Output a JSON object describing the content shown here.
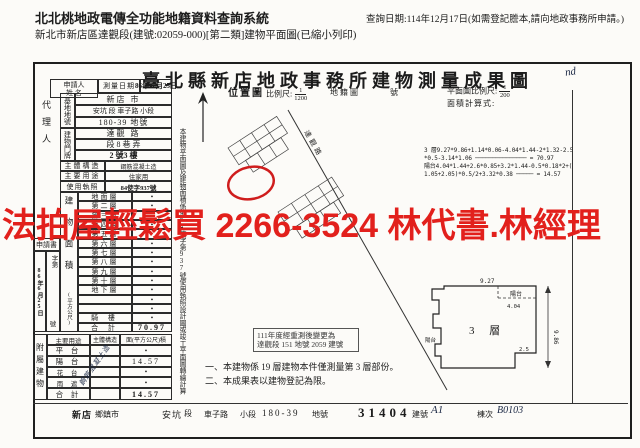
{
  "header": {
    "system_title": "北北桃地政電傳全功能地籍資料查詢系統",
    "doc_line": "新北市新店區達觀段(建號:02059-000)[第二類]建物平面圖(已縮小列印)",
    "query_date": "查詢日期:114年12月17日(如需登記謄本,請向地政事務所申請。)"
  },
  "form": {
    "title": "臺北縣新店地政事務所建物測量成果圖",
    "handwritten_mark": "nd",
    "applicant_line1": "申請人",
    "applicant_line2": "姓 名",
    "agent_label": "代理人",
    "survey_date_label": "測量日期",
    "survey_date_value": "86年 6.月25日",
    "site_label": "基地地號",
    "site_row1": "新店  市",
    "site_row2": "安坑 段 車子路 小段",
    "site_row3": "180-39 地號",
    "address_label": "建物門牌",
    "address_row1": "達觀  路",
    "address_row2": "段 8 巷  弄",
    "address_row3": "2 號3  樓",
    "structure_label": "主體構造",
    "structure_value": "鋼筋混凝土造",
    "usage_label": "主要用途",
    "usage_value": "住家用",
    "license_label": "使用執照",
    "license_value": "84使字937號",
    "area_label": "建物面積",
    "area_unit": "(平方公尺)",
    "area_rows": [
      {
        "label": "地面層",
        "value": "•"
      },
      {
        "label": "第二層",
        "value": "•"
      },
      {
        "label": "第三層",
        "value": "•"
      },
      {
        "label": "第四層",
        "value": "•"
      },
      {
        "label": "第五層",
        "value": "•"
      },
      {
        "label": "第六層",
        "value": "•"
      },
      {
        "label": "第七層",
        "value": "•"
      },
      {
        "label": "第八層",
        "value": "•"
      },
      {
        "label": "第九層",
        "value": "•"
      },
      {
        "label": "第十層",
        "value": "•"
      },
      {
        "label": "地下層",
        "value": "•"
      },
      {
        "label": "",
        "value": "•"
      },
      {
        "label": "",
        "value": "•"
      },
      {
        "label": "騎 樓",
        "value": "•"
      },
      {
        "label": "合 計",
        "value": "70.97"
      }
    ],
    "application_header": "申請書",
    "application_date": "86年6月25日",
    "application_word": "字第",
    "application_no": "號",
    "attached_label": "附屬建物",
    "attached_headers": [
      "主要用途",
      "主體構造",
      "面(平方公尺)積"
    ],
    "attached_rows": [
      {
        "label": "平 台",
        "value": "•"
      },
      {
        "label": "陽 台",
        "value": "14.57"
      },
      {
        "label": "花 台",
        "value": "•"
      },
      {
        "label": "雨 遮",
        "value": "•"
      },
      {
        "label": "合 計",
        "value": "14.57"
      }
    ],
    "attached_handwriting": "鋼筋混凝土造",
    "side_note": "本建物平面圖及建物面積係依84使字第937號使用執照設計圖或竣工平面圖轉繪計算"
  },
  "map": {
    "location_label": "位置圖",
    "scale_label": "比例尺:",
    "scale_num": "1",
    "scale_den": "1200",
    "cadastral_label": "地籍圖",
    "number_label": "號",
    "plan_scale_label": "平面圖比例尺:",
    "plan_scale_num": "1",
    "plan_scale_den": "200",
    "calc_label": "面積計算式:",
    "road_name": "達觀路",
    "calc_lines": [
      "3 層9.27*9.86+1.14*0.06-4.04*1.44-2*1.32-2.5",
      "*0.5-3.14*1.06 ─────────────── = 70.97",
      "陽台4.04*1.44+2.6*0.85+3.2*1.44-0.5*0.18*2+(",
      "1.05+2.05)*0.5/2+3.32*0.38 ───── = 14.57"
    ],
    "stamp_line1": "111年度經重測後變更為",
    "stamp_line2": "達觀段 151 地號 2059 建號"
  },
  "plan": {
    "floor_label": "3  層",
    "top_dim": "9.27",
    "right_dim": "9.86",
    "balcony_label": "陽台",
    "balcony_dim": "4.04",
    "notch_dim": "2.5",
    "left_balcony_label": "陽台"
  },
  "notes": {
    "line1": "一、本建物係 19 層建物本件僅測量第  3 層部份。",
    "line2": "二、本成果表以建物登記為限。"
  },
  "footer": {
    "town": "新店",
    "town_label": "鄉鎮市",
    "section": "安坑",
    "section_label": "段",
    "subsection": "車子路",
    "subsection_label": "小段",
    "parcel": "180-39",
    "parcel_label": "地號",
    "building_no": "31404",
    "building_no_label": "建號",
    "building_no_hand": "A1",
    "block_label": "棟次",
    "block_hand": "B0103"
  },
  "overlay": {
    "text": "法拍屋輕鬆買 2266-3524 林代書.林經理",
    "color": "#e2201c"
  }
}
